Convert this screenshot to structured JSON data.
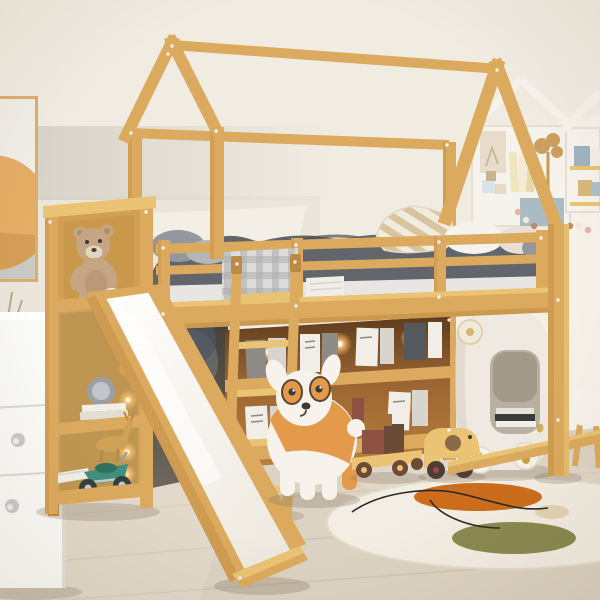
{
  "meta": {
    "description": "Kids bedroom product photo: natural wood house-frame loft bed with white slide, ladder, under-bed display bookshelf with warm LED lights, left storage tower with teddy bear, puppy stool, wooden toys, bunny side table, house-shaped wall shelves, round rug with orange and olive blobs, white dresser and abstract wall art",
    "room": "children's bedroom",
    "photo_type": "furniture lifestyle product photo"
  },
  "colors": {
    "wall": "#f1ece2",
    "shadowBand": "#d7d1c7",
    "wallBright": "#fbf8f1",
    "wallPatch": "#f5f0e7",
    "baseboard": "#f7f4ee",
    "floor": "#ddd3c3",
    "plankDark": "#c6baa5",
    "wood": "#dcaa5e",
    "woodDark": "#bc8a42",
    "woodLight": "#eac374",
    "woodPale": "#f3dcae",
    "white": "#f6f3ec",
    "paper": "#f1eee8",
    "slideSurface": "#f6f2e9",
    "duvet": "#62656c",
    "duvetDark": "#4b4e55",
    "plaidBase": "#dedcd8",
    "plaidLine": "#a6a9ab",
    "pillowBase": "#f2ecdf",
    "pillowBeige": "#d8c49f",
    "grayPillow": "#94979c",
    "grayPillowLight": "#b4b6ba",
    "teddy": "#c6a584",
    "teddyDark": "#ae8d6c",
    "muzzle": "#e5d4bd",
    "dogOrange": "#e49a4b",
    "dogWhite": "#f7f3ec",
    "dark": "#3a3a38",
    "rug": "#f3eee3",
    "rugOrange": "#cc6d1c",
    "rugOlive": "#8a8950",
    "rugBeige": "#e4d4b6",
    "motorTeal": "#3f8f7d",
    "motorTealDark": "#2f6f60",
    "metal": "#c9c9c9",
    "blueBox": "#a9bcc4",
    "cabinet": "#efeae1",
    "interiorDark": "#b9b0a2",
    "gold": "#c9a040",
    "artOrange": "#e5ad66",
    "artGray": "#cac9c5",
    "beadPink": "#e3b4a8",
    "beadCream": "#f2e8dc",
    "beadBrown": "#c08a6a",
    "woodToyDark": "#6b4a38",
    "blockRed": "#8d5243",
    "blockBrown": "#6b4a38",
    "bookGray": "#8e8b86",
    "bookDark": "#55585d",
    "bookLight": "#d8d5cf",
    "shadow": "#8a7c66",
    "vase": "#cfc4b4",
    "stem": "#b8a88e",
    "deer": "#cfa258",
    "glassGray": "#9aa0a6",
    "glassGrayLight": "#c2c6ca",
    "ledCore": "#fff6e2",
    "fringe": "#cfcfcd",
    "ledGlow": "#ffc46e"
  },
  "inventory": [
    {
      "name": "house-loft-bed",
      "desc": "natural wood loft bed with house gable frame"
    },
    {
      "name": "slide",
      "desc": "white slide with wood rails"
    },
    {
      "name": "ladder",
      "desc": "wood ladder to loft"
    },
    {
      "name": "under-bed-bookshelf",
      "desc": "display bookshelf with warm LED lighting"
    },
    {
      "name": "storage-tower",
      "desc": "left shelf tower with teddy bear, clock, books, deer figurine, toy motorcycle"
    },
    {
      "name": "bedding",
      "desc": "gray duvet, gingham blanket, striped beige pillow, white and gray pillows"
    },
    {
      "name": "dog-stool",
      "desc": "orange and white puppy stool"
    },
    {
      "name": "bunny-side-table",
      "desc": "white rounded cabinet with paw feet and bunny figurine"
    },
    {
      "name": "wall-shelves",
      "desc": "house-shaped wall shelves with blocks, tree sculpture, books"
    },
    {
      "name": "round-rug",
      "desc": "cream rug with orange and olive blobs and black squiggle"
    },
    {
      "name": "wooden-toys",
      "desc": "block truck and elephant pull toy"
    },
    {
      "name": "white-dresser",
      "desc": "white drawer unit at left edge"
    },
    {
      "name": "wall-art",
      "desc": "framed abstract print with orange circle"
    }
  ]
}
